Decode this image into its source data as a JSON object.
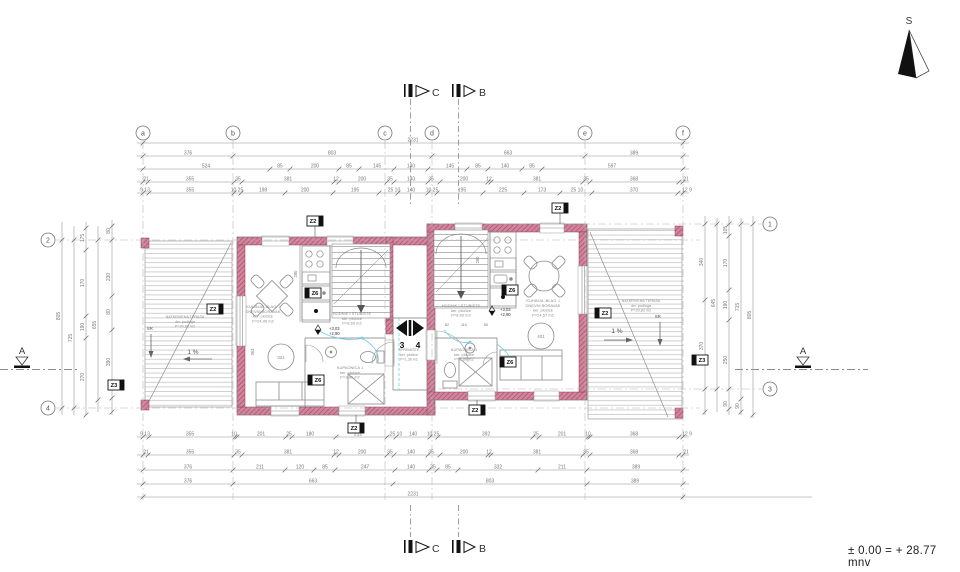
{
  "north": {
    "label": "S"
  },
  "footer": {
    "elevation_note": "± 0.00 = + 28.77 mnv"
  },
  "grid": {
    "bubbleY": 133,
    "bubbleXLeft": 48,
    "bubbleXRight": 770,
    "cols": [
      [
        "a",
        143
      ],
      [
        "b",
        233
      ],
      [
        "c",
        385
      ],
      [
        "d",
        432
      ],
      [
        "e",
        585
      ],
      [
        "f",
        683
      ]
    ],
    "colLine": [
      141,
      500
    ],
    "left": [
      [
        "2",
        240
      ],
      [
        "4",
        408
      ]
    ],
    "leftLine": [
      56,
      700
    ],
    "right": [
      [
        "1",
        224
      ],
      [
        "3",
        389
      ]
    ],
    "rightLine": [
      438,
      762
    ]
  },
  "dims": [
    {
      "o": "h",
      "y": 143,
      "x1": 137,
      "x2": 689,
      "ticks": [
        143,
        683
      ],
      "labels": [
        [
          413,
          "2231"
        ]
      ]
    },
    {
      "o": "h",
      "y": 156,
      "x1": 137,
      "x2": 689,
      "ticks": [
        143,
        233,
        432,
        585,
        683
      ],
      "labels": [
        [
          188,
          "376"
        ],
        [
          332,
          "803"
        ],
        [
          508,
          "663"
        ],
        [
          634,
          "389"
        ]
      ]
    },
    {
      "o": "h",
      "y": 169,
      "x1": 137,
      "x2": 689,
      "ticks": [
        143,
        270,
        290,
        339,
        359,
        394,
        428,
        467,
        488,
        522,
        542,
        683
      ],
      "labels": [
        [
          206,
          "524"
        ],
        [
          280,
          "85"
        ],
        [
          315,
          "200"
        ],
        [
          349,
          "85"
        ],
        [
          377,
          "145"
        ],
        [
          411,
          "140"
        ],
        [
          450,
          "145"
        ],
        [
          478,
          "85"
        ],
        [
          505,
          "140"
        ],
        [
          532,
          "85"
        ],
        [
          612,
          "597"
        ]
      ]
    },
    {
      "o": "h",
      "y": 182,
      "x1": 137,
      "x2": 689,
      "ticks": [
        143,
        148,
        234,
        242,
        334,
        339,
        387,
        394,
        428,
        440,
        488,
        491,
        583,
        590,
        679,
        683
      ],
      "labels": [
        [
          146,
          "21"
        ],
        [
          190,
          "355"
        ],
        [
          238,
          "35"
        ],
        [
          288,
          "381"
        ],
        [
          336,
          "12"
        ],
        [
          362,
          "200"
        ],
        [
          390,
          "35"
        ],
        [
          411,
          "140"
        ],
        [
          431,
          "35"
        ],
        [
          464,
          "200"
        ],
        [
          489,
          "12"
        ],
        [
          537,
          "381"
        ],
        [
          586,
          "35"
        ],
        [
          634,
          "368"
        ],
        [
          686,
          "21"
        ]
      ]
    },
    {
      "o": "h",
      "y": 193,
      "x1": 137,
      "x2": 689,
      "ticks": [
        143,
        149,
        234,
        241,
        285,
        333,
        379,
        398,
        428,
        437,
        483,
        524,
        560,
        592,
        678,
        683
      ],
      "labels": [
        [
          145,
          "9 13"
        ],
        [
          190,
          "355"
        ],
        [
          237,
          "10 25"
        ],
        [
          263,
          "198"
        ],
        [
          305,
          "200"
        ],
        [
          355,
          "195"
        ],
        [
          394,
          "25 10"
        ],
        [
          411,
          "140"
        ],
        [
          432,
          "10 25"
        ],
        [
          462,
          "195"
        ],
        [
          503,
          "225"
        ],
        [
          542,
          "173"
        ],
        [
          577,
          "25 10"
        ],
        [
          634,
          "370"
        ],
        [
          687,
          "12 9"
        ]
      ]
    },
    {
      "o": "h",
      "y": 437,
      "x1": 137,
      "x2": 689,
      "ticks": [
        143,
        149,
        235,
        237,
        286,
        292,
        336,
        387,
        396,
        430,
        438,
        533,
        539,
        588,
        590,
        679,
        683
      ],
      "labels": [
        [
          145,
          "9 13"
        ],
        [
          190,
          "355"
        ],
        [
          234,
          "10"
        ],
        [
          261,
          "201"
        ],
        [
          289,
          "25"
        ],
        [
          310,
          "180"
        ],
        [
          358,
          "212"
        ],
        [
          396,
          "25 10"
        ],
        [
          413,
          "140"
        ],
        [
          433,
          "10 25"
        ],
        [
          486,
          "392"
        ],
        [
          536,
          "25"
        ],
        [
          562,
          "201"
        ],
        [
          588,
          "10"
        ],
        [
          634,
          "368"
        ],
        [
          687,
          "12 9"
        ]
      ]
    },
    {
      "o": "h",
      "y": 455,
      "x1": 137,
      "x2": 689,
      "ticks": [
        143,
        148,
        234,
        242,
        334,
        339,
        387,
        394,
        428,
        440,
        488,
        491,
        583,
        590,
        679,
        683
      ],
      "labels": [
        [
          146,
          "21"
        ],
        [
          190,
          "355"
        ],
        [
          238,
          "35"
        ],
        [
          288,
          "381"
        ],
        [
          336,
          "12"
        ],
        [
          362,
          "200"
        ],
        [
          390,
          "35"
        ],
        [
          411,
          "140"
        ],
        [
          431,
          "35"
        ],
        [
          464,
          "200"
        ],
        [
          489,
          "12"
        ],
        [
          537,
          "381"
        ],
        [
          586,
          "35"
        ],
        [
          634,
          "368"
        ],
        [
          686,
          "21"
        ]
      ]
    },
    {
      "o": "h",
      "y": 470,
      "x1": 137,
      "x2": 689,
      "ticks": [
        143,
        233,
        285,
        314,
        335,
        395,
        429,
        437,
        458,
        538,
        587,
        683
      ],
      "labels": [
        [
          188,
          "376"
        ],
        [
          260,
          "211"
        ],
        [
          300,
          "120"
        ],
        [
          325,
          "85"
        ],
        [
          365,
          "247"
        ],
        [
          411,
          "140"
        ],
        [
          433,
          "35"
        ],
        [
          448,
          "85"
        ],
        [
          498,
          "332"
        ],
        [
          562,
          "211"
        ],
        [
          636,
          "389"
        ]
      ]
    },
    {
      "o": "h",
      "y": 484,
      "x1": 137,
      "x2": 689,
      "ticks": [
        143,
        233,
        393,
        587,
        683
      ],
      "labels": [
        [
          188,
          "376"
        ],
        [
          313,
          "663"
        ],
        [
          490,
          "803"
        ],
        [
          635,
          "389"
        ]
      ]
    },
    {
      "o": "h",
      "y": 497,
      "x1": 137,
      "x2": 812,
      "ticks": [
        143,
        683
      ],
      "labels": [
        [
          413,
          "2231"
        ]
      ]
    },
    {
      "o": "v",
      "x": 62,
      "y1": 222,
      "y2": 415,
      "ticks": [
        240,
        408
      ],
      "labels": [
        [
          316,
          "805"
        ]
      ]
    },
    {
      "o": "v",
      "x": 74,
      "y1": 226,
      "y2": 415,
      "ticks": [
        240,
        408
      ],
      "labels": [
        [
          338,
          "725"
        ]
      ]
    },
    {
      "o": "v",
      "x": 86,
      "y1": 222,
      "y2": 415,
      "ticks": [
        228,
        250,
        316,
        338,
        415
      ],
      "labels": [
        [
          238,
          "175"
        ],
        [
          283,
          "170"
        ],
        [
          327,
          "190"
        ],
        [
          377,
          "270"
        ]
      ]
    },
    {
      "o": "v",
      "x": 98,
      "y1": 226,
      "y2": 412,
      "ticks": [
        240,
        400
      ],
      "labels": [
        [
          325,
          "655"
        ]
      ]
    },
    {
      "o": "v",
      "x": 112,
      "y1": 220,
      "y2": 415,
      "ticks": [
        226,
        240,
        296,
        330,
        398,
        412
      ],
      "labels": [
        [
          231,
          "80"
        ],
        [
          277,
          "230"
        ],
        [
          312,
          "80"
        ],
        [
          362,
          "390"
        ]
      ]
    },
    {
      "o": "v",
      "x": 705,
      "y1": 216,
      "y2": 415,
      "ticks": [
        224,
        300,
        389,
        412
      ],
      "labels": [
        [
          262,
          "340"
        ],
        [
          346,
          "370"
        ]
      ]
    },
    {
      "o": "v",
      "x": 717,
      "y1": 218,
      "y2": 412,
      "ticks": [
        224,
        389
      ],
      "labels": [
        [
          303,
          "645"
        ]
      ]
    },
    {
      "o": "v",
      "x": 729,
      "y1": 216,
      "y2": 415,
      "ticks": [
        224,
        236,
        290,
        320,
        389,
        409
      ],
      "labels": [
        [
          230,
          "105"
        ],
        [
          263,
          "170"
        ],
        [
          305,
          "190"
        ],
        [
          360,
          "250"
        ],
        [
          404,
          "90"
        ]
      ]
    },
    {
      "o": "v",
      "x": 741,
      "y1": 218,
      "y2": 415,
      "ticks": [
        224,
        399,
        412
      ],
      "labels": [
        [
          307,
          "715"
        ],
        [
          406,
          "90"
        ]
      ]
    },
    {
      "o": "v",
      "x": 753,
      "y1": 216,
      "y2": 418,
      "ticks": [
        224,
        415
      ],
      "labels": [
        [
          315,
          "805"
        ]
      ]
    }
  ],
  "rooms": [
    {
      "n": "room-label-left-living",
      "x": 263,
      "y": 308,
      "lines": [
        "KUHINJA, BLAG. I",
        "DNEVNI BORAVAK",
        "ker. pločice",
        "P=24,96 m2"
      ]
    },
    {
      "n": "room-label-left-hall",
      "x": 352,
      "y": 315,
      "lines": [
        "HODNIK I STUBIŠTE",
        "ker. pločice",
        "P=8,60 m2"
      ]
    },
    {
      "n": "room-label-left-bath",
      "x": 350,
      "y": 369,
      "lines": [
        "KUPAONICA 1",
        "ker. pločice",
        "P=3,86 m2"
      ]
    },
    {
      "n": "room-label-left-storage",
      "x": 409,
      "y": 351,
      "s": 3.6,
      "lines": [
        "SPREMIŠTE",
        "ker. pločice",
        "P=1,36 m2"
      ]
    },
    {
      "n": "room-label-right-hall",
      "x": 461,
      "y": 307,
      "lines": [
        "HODNIK I STUBIŠTE",
        "ker. pločice",
        "P=8,60 m2"
      ]
    },
    {
      "n": "room-label-right-living",
      "x": 543,
      "y": 302,
      "lines": [
        "KUHINJA, BLAG. I",
        "DNEVNI BORAVAK",
        "ker. pločice",
        "P=24,57 m2"
      ]
    },
    {
      "n": "room-label-right-bath",
      "x": 464,
      "y": 351,
      "lines": [
        "KUPAONICA 1",
        "ker. pločice",
        "P=3,86 m2"
      ]
    },
    {
      "n": "room-label-left-terrace",
      "x": 185,
      "y": 318,
      "s": 3.7,
      "lines": [
        "NATKRIVENA TERASA",
        "drv. podloga",
        "P=20,83 m2"
      ]
    },
    {
      "n": "room-label-right-terrace",
      "x": 641,
      "y": 302,
      "s": 3.7,
      "lines": [
        "NATKRIVENA TERASA",
        "drv. podloga",
        "P=20,83 m2"
      ]
    }
  ],
  "tags": [
    {
      "n": "tag-z2-left-terrace",
      "x": 215,
      "y": 309,
      "t": "Z2",
      "side": "r"
    },
    {
      "n": "tag-z3-left",
      "x": 116,
      "y": 385,
      "t": "Z3",
      "side": "r"
    },
    {
      "n": "tag-z2-left-top",
      "x": 315,
      "y": 221,
      "t": "Z2",
      "side": "r",
      "lead": [
        315,
        226,
        237
      ]
    },
    {
      "n": "tag-z6-left-kitchen",
      "x": 313,
      "y": 293,
      "t": "Z6",
      "side": "l"
    },
    {
      "n": "tag-z6-left-bath",
      "x": 316,
      "y": 380,
      "t": "Z6",
      "side": "l"
    },
    {
      "n": "tag-z2-left-bottom",
      "x": 356,
      "y": 428,
      "t": "Z2",
      "side": "r",
      "lead": [
        356,
        423,
        415
      ]
    },
    {
      "n": "tag-z2-right-top",
      "x": 560,
      "y": 208,
      "t": "Z2",
      "side": "r",
      "lead": [
        560,
        213,
        224
      ]
    },
    {
      "n": "tag-z6-right-kitchen",
      "x": 510,
      "y": 290,
      "t": "Z6",
      "side": "l"
    },
    {
      "n": "tag-z6-right-bath",
      "x": 508,
      "y": 362,
      "t": "Z6",
      "side": "l"
    },
    {
      "n": "tag-z2-right-bottom",
      "x": 477,
      "y": 410,
      "t": "Z2",
      "side": "r",
      "lead": [
        477,
        405,
        400
      ]
    },
    {
      "n": "tag-z2-right-terrace",
      "x": 603,
      "y": 313,
      "t": "Z2",
      "side": "l"
    },
    {
      "n": "tag-z3-right",
      "x": 700,
      "y": 360,
      "t": "Z3",
      "side": "l"
    }
  ],
  "texts": [
    {
      "n": "section-letter-top-c",
      "x": 432,
      "y": 96,
      "t": "C",
      "s": 10.5,
      "a": "start",
      "c": "#333"
    },
    {
      "n": "section-letter-top-b",
      "x": 479,
      "y": 96,
      "t": "B",
      "s": 10.5,
      "a": "start",
      "c": "#333"
    },
    {
      "n": "section-letter-bottom-c",
      "x": 432,
      "y": 552,
      "t": "C",
      "s": 10.5,
      "a": "start",
      "c": "#333"
    },
    {
      "n": "section-letter-bottom-b",
      "x": 479,
      "y": 552,
      "t": "B",
      "s": 10.5,
      "a": "start",
      "c": "#333"
    },
    {
      "n": "section-a-left-label",
      "x": 22,
      "y": 354,
      "t": "A",
      "s": 9.5,
      "c": "#333"
    },
    {
      "n": "section-a-right-label",
      "x": 803,
      "y": 354,
      "t": "A",
      "s": 9.5,
      "c": "#333"
    },
    {
      "n": "detail-marker-3-label",
      "x": 402,
      "y": 348,
      "t": "3",
      "s": 8.5,
      "w": "bold",
      "c": "#111"
    },
    {
      "n": "detail-marker-4-label",
      "x": 418,
      "y": 348,
      "t": "4",
      "s": 8.5,
      "w": "bold",
      "c": "#111"
    },
    {
      "n": "slope-left-label",
      "x": 193,
      "y": 354,
      "t": "1 %",
      "s": 6.5,
      "c": "#555"
    },
    {
      "n": "slope-right-label",
      "x": 617,
      "y": 333,
      "t": "1 %",
      "s": 6.5,
      "c": "#555"
    },
    {
      "n": "stairs-left-terrace-label",
      "x": 150,
      "y": 330,
      "t": "8R",
      "s": 4.5,
      "c": "#555"
    },
    {
      "n": "stairs-right-terrace-label",
      "x": 658,
      "y": 318,
      "t": "8R",
      "s": 4.5,
      "c": "#555"
    },
    {
      "n": "level-left-upper",
      "x": 329,
      "y": 330,
      "t": "+3,03",
      "s": 4.2,
      "a": "start",
      "c": "#333"
    },
    {
      "n": "level-left-lower",
      "x": 329,
      "y": 335,
      "t": "+2,90",
      "s": 4.2,
      "a": "start",
      "c": "#333"
    },
    {
      "n": "level-right-upper",
      "x": 500,
      "y": 311,
      "t": "+3,03",
      "s": 4.2,
      "a": "start",
      "c": "#333"
    },
    {
      "n": "level-right-lower",
      "x": 500,
      "y": 316,
      "t": "+2,90",
      "s": 4.2,
      "a": "start",
      "c": "#333"
    },
    {
      "n": "table-left-number",
      "x": 281,
      "y": 359,
      "t": "321",
      "s": 4.5,
      "c": "#8a8a8a"
    },
    {
      "n": "table-right-number",
      "x": 541,
      "y": 338,
      "t": "401",
      "s": 4.5,
      "c": "#8a8a8a"
    },
    {
      "n": "dim-363",
      "x": 254,
      "y": 352,
      "t": "363",
      "s": 4.2,
      "r": -90
    },
    {
      "n": "dim-280",
      "x": 297,
      "y": 274,
      "t": "280",
      "s": 4.2,
      "r": -90
    },
    {
      "n": "dim-290",
      "x": 479,
      "y": 260,
      "t": "290",
      "s": 4.2,
      "r": -90
    },
    {
      "n": "dim-82",
      "x": 447,
      "y": 326,
      "t": "82",
      "s": 3.8
    },
    {
      "n": "dim-110",
      "x": 464,
      "y": 326,
      "t": "110",
      "s": 3.8
    },
    {
      "n": "dim-60",
      "x": 486,
      "y": 326,
      "t": "60",
      "s": 3.8
    }
  ]
}
